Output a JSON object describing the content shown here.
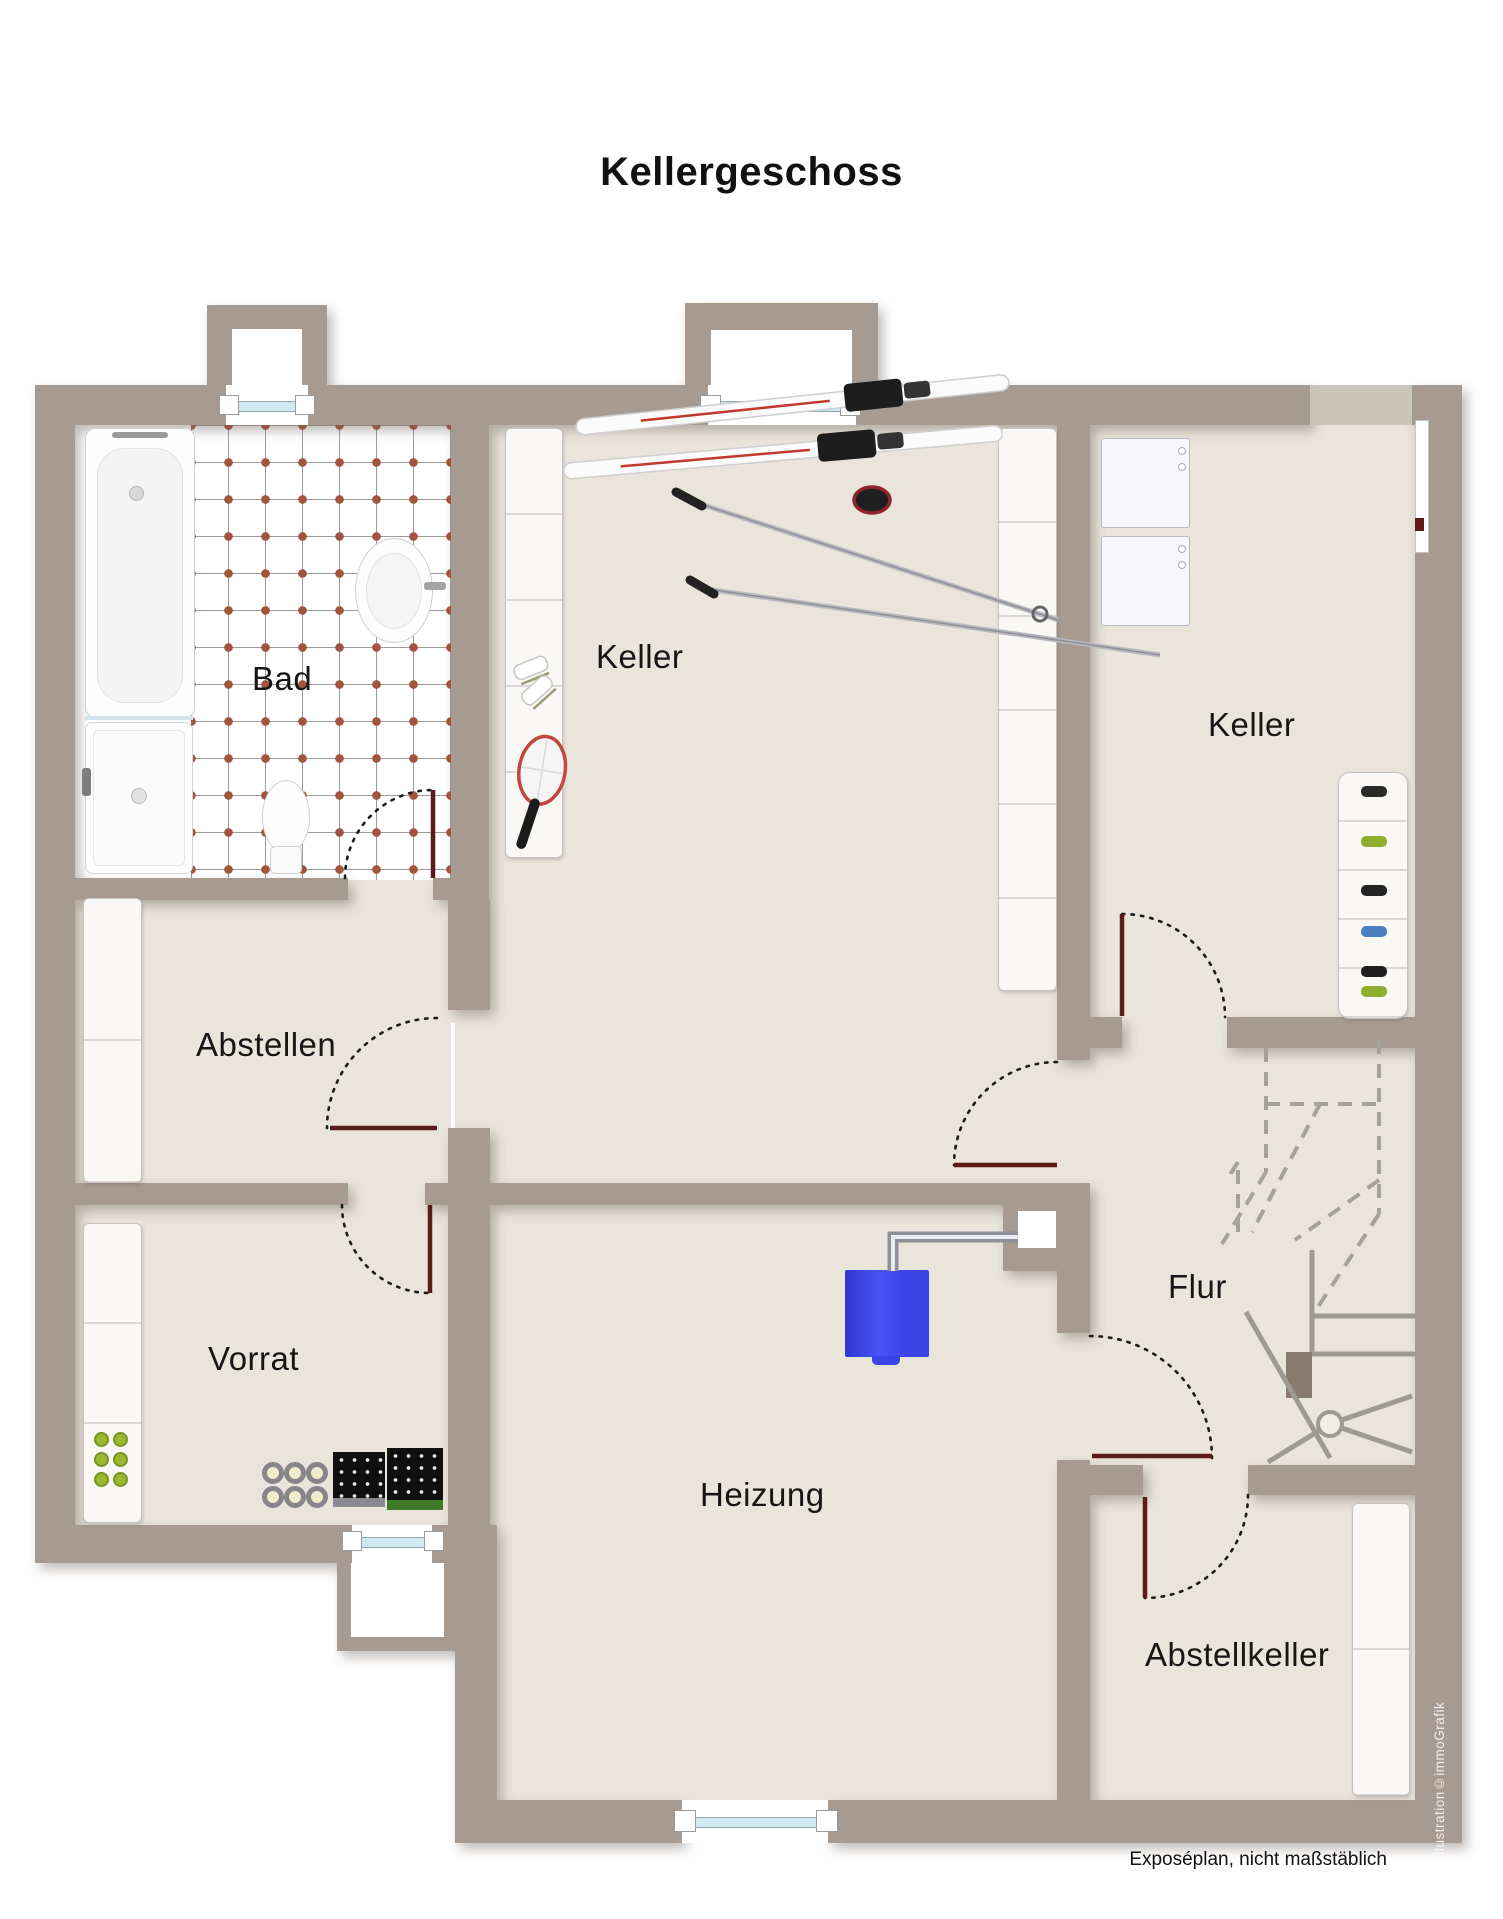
{
  "title": "Kellergeschoss",
  "footer_note": "Exposéplan, nicht maßstäblich",
  "watermark": "illustration©immoGrafik",
  "rooms": [
    {
      "id": "bad",
      "label": "Bad"
    },
    {
      "id": "keller-mitte",
      "label": "Keller"
    },
    {
      "id": "keller-rechts",
      "label": "Keller"
    },
    {
      "id": "abstellen",
      "label": "Abstellen"
    },
    {
      "id": "vorrat",
      "label": "Vorrat"
    },
    {
      "id": "heizung",
      "label": "Heizung"
    },
    {
      "id": "flur",
      "label": "Flur"
    },
    {
      "id": "abstellkeller",
      "label": "Abstellkeller"
    }
  ],
  "fixtures": [
    "bathtub",
    "shower",
    "toilet",
    "sink",
    "tiled-floor",
    "skis",
    "ski-poles",
    "ice-skates",
    "tennis-racket",
    "storage-shelves",
    "washing-machine",
    "dryer",
    "shoe-rack",
    "staircase",
    "boiler",
    "flue-pipe",
    "chimney",
    "wine-bottles",
    "wine-racks",
    "preserve-jars",
    "windows",
    "door-swings"
  ],
  "colors": {
    "wall": "#a79a91",
    "floor": "#eae5db",
    "door": "#5c1a18",
    "boiler": "#3a43e6",
    "glass": "#cfe9f2",
    "tile_dot": "#a2543e",
    "stair": "#9d9a92",
    "ink": "#1b1b1b"
  }
}
